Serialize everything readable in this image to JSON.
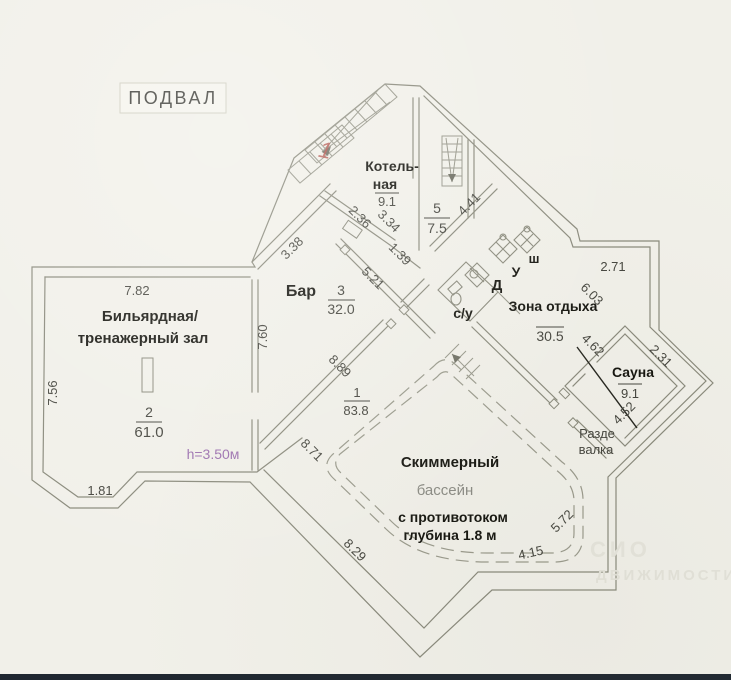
{
  "title": "ПОДВАЛ",
  "mark": {
    "red_revision": "1"
  },
  "note": {
    "height": "h=3.50м"
  },
  "rooms": {
    "billiard": {
      "line1": "Бильярдная/",
      "line2": "тренажерный зал",
      "num": "2",
      "area": "61.0"
    },
    "bar": {
      "name": "Бар",
      "num": "3",
      "area": "32.0"
    },
    "boiler": {
      "line1": "Котель-",
      "line2": "ная",
      "area": "9.1"
    },
    "room5": {
      "num": "5",
      "area": "7.5"
    },
    "hall": {
      "num": "1",
      "area": "83.8"
    },
    "lounge": {
      "name": "Зона отдыха",
      "area": "30.5"
    },
    "sauna": {
      "name": "Сауна",
      "area": "9.1"
    },
    "dressing": {
      "line1": "Разде",
      "line2": "валка"
    },
    "wc": {
      "name": "с/у"
    },
    "shower": {
      "d": "Д",
      "u": "У",
      "sh": "ш"
    },
    "pool": {
      "line1": "Скиммерный",
      "line2": "бассейн",
      "line3": "с противотоком",
      "line4": "глубина 1.8 м"
    }
  },
  "dims": {
    "d782": "7.82",
    "d756": "7.56",
    "d181": "1.81",
    "d760": "7.60",
    "d338": "3.38",
    "d236": "2.36",
    "d334": "3.34",
    "d139": "1.39",
    "d521": "5.21",
    "d889": "8.89",
    "d441": "4.41",
    "d271": "2.71",
    "d603": "6.03",
    "d462": "4.62",
    "d231": "2.31",
    "d452": "4.52",
    "d871": "8.71",
    "d829": "8.29",
    "d415": "4.15",
    "d572": "5.72"
  },
  "watermark": {
    "line1": "СИО",
    "line2": "ДВИЖИМОСТИ"
  },
  "colors": {
    "paper": "#f1f0e9",
    "line": "#8a8a7c",
    "ink": "#15150f",
    "number": "#45453e",
    "purple": "#9b6fae",
    "red": "#b5554d",
    "pool_text": "#8b8b84",
    "watermark": "#e6e5dc"
  }
}
